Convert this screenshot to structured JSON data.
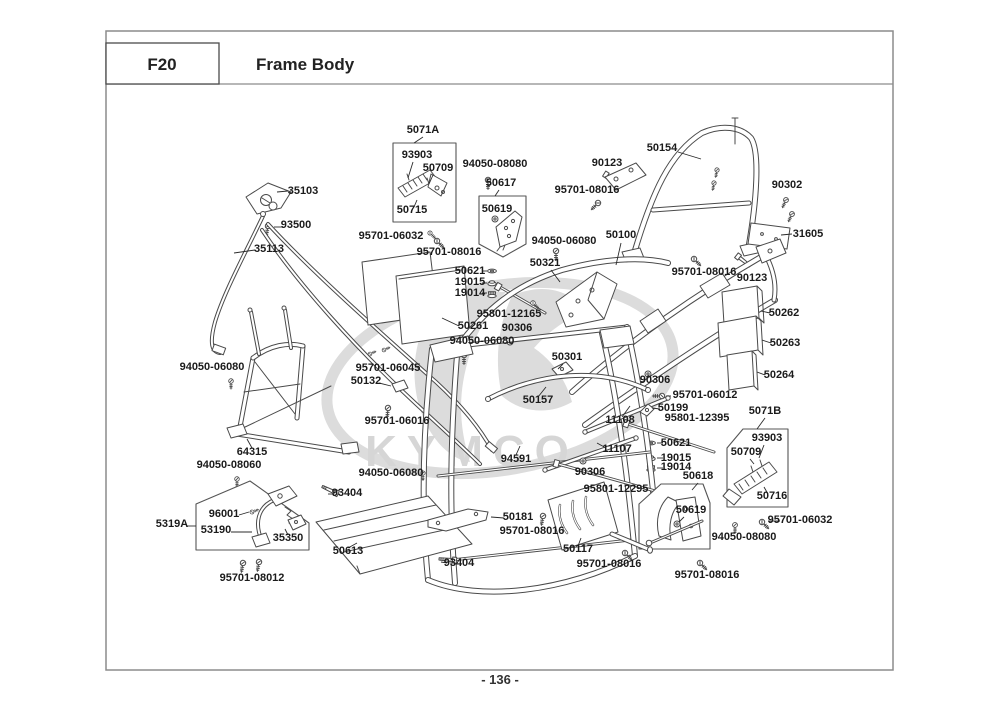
{
  "header": {
    "code": "F20",
    "title": "Frame Body"
  },
  "footer": {
    "page_number": "- 136 -"
  },
  "watermark": {
    "brand": "KYMCO"
  },
  "colors": {
    "ink": "#4a4a4a",
    "label": "#1b1b1b",
    "border": "#8c8c8c",
    "watermark": "#d6d6d6"
  },
  "diagram": {
    "labels": [
      {
        "text": "5071A",
        "x": 423,
        "y": 133,
        "leader": [
          423,
          137,
          414,
          143
        ]
      },
      {
        "text": "93903",
        "x": 417,
        "y": 158,
        "leader": [
          413,
          162,
          408,
          178
        ]
      },
      {
        "text": "50709",
        "x": 438,
        "y": 171,
        "leader": [
          433,
          175,
          429,
          184
        ]
      },
      {
        "text": "50715",
        "x": 412,
        "y": 213,
        "leader": [
          414,
          207,
          417,
          200
        ]
      },
      {
        "text": "94050-08080",
        "x": 495,
        "y": 167
      },
      {
        "text": "50617",
        "x": 501,
        "y": 186,
        "leader": [
          499,
          190,
          495,
          196
        ]
      },
      {
        "text": "50619",
        "x": 497,
        "y": 212
      },
      {
        "text": "90123",
        "x": 607,
        "y": 166
      },
      {
        "text": "50154",
        "x": 662,
        "y": 151,
        "leader": [
          678,
          152,
          701,
          159
        ]
      },
      {
        "text": "95701-08016",
        "x": 587,
        "y": 193
      },
      {
        "text": "90302",
        "x": 787,
        "y": 188
      },
      {
        "text": "95701-06032",
        "x": 391,
        "y": 239
      },
      {
        "text": "95701-08016",
        "x": 449,
        "y": 255
      },
      {
        "text": "94050-06080",
        "x": 564,
        "y": 244
      },
      {
        "text": "50100",
        "x": 621,
        "y": 238,
        "leader": [
          621,
          243,
          616,
          265
        ]
      },
      {
        "text": "31605",
        "x": 808,
        "y": 237,
        "leader": [
          792,
          234,
          781,
          235
        ]
      },
      {
        "text": "95701-08016",
        "x": 704,
        "y": 275
      },
      {
        "text": "90123",
        "x": 752,
        "y": 281
      },
      {
        "text": "50621",
        "x": 470,
        "y": 274,
        "leader": [
          482,
          271,
          487,
          271
        ]
      },
      {
        "text": "19015",
        "x": 470,
        "y": 285,
        "leader": [
          482,
          283,
          487,
          283
        ]
      },
      {
        "text": "19014",
        "x": 470,
        "y": 296,
        "leader": [
          482,
          293,
          487,
          293
        ]
      },
      {
        "text": "50321",
        "x": 545,
        "y": 266,
        "leader": [
          551,
          270,
          560,
          282
        ]
      },
      {
        "text": "95801-12165",
        "x": 509,
        "y": 317
      },
      {
        "text": "50261",
        "x": 473,
        "y": 329,
        "leader": [
          459,
          326,
          442,
          318
        ]
      },
      {
        "text": "90306",
        "x": 517,
        "y": 331
      },
      {
        "text": "50262",
        "x": 784,
        "y": 316,
        "leader": [
          770,
          313,
          761,
          311
        ]
      },
      {
        "text": "50263",
        "x": 785,
        "y": 346,
        "leader": [
          771,
          343,
          762,
          340
        ]
      },
      {
        "text": "94050-06080",
        "x": 482,
        "y": 344
      },
      {
        "text": "50301",
        "x": 567,
        "y": 360,
        "leader": [
          563,
          364,
          558,
          369
        ]
      },
      {
        "text": "50264",
        "x": 779,
        "y": 378,
        "leader": [
          765,
          375,
          757,
          372
        ]
      },
      {
        "text": "94050-06080",
        "x": 212,
        "y": 370
      },
      {
        "text": "95701-06045",
        "x": 388,
        "y": 371
      },
      {
        "text": "50132",
        "x": 366,
        "y": 384,
        "leader": [
          379,
          383,
          391,
          386
        ]
      },
      {
        "text": "90306",
        "x": 655,
        "y": 383
      },
      {
        "text": "95701-06012",
        "x": 705,
        "y": 398,
        "leader": [
          671,
          396,
          666,
          396
        ]
      },
      {
        "text": "50199",
        "x": 673,
        "y": 411,
        "leader": [
          660,
          409,
          652,
          408
        ]
      },
      {
        "text": "50157",
        "x": 538,
        "y": 403,
        "leader": [
          538,
          397,
          546,
          387
        ]
      },
      {
        "text": "95801-12395",
        "x": 697,
        "y": 421
      },
      {
        "text": "5071B",
        "x": 765,
        "y": 414,
        "leader": [
          765,
          418,
          757,
          429
        ]
      },
      {
        "text": "95701-06016",
        "x": 397,
        "y": 424
      },
      {
        "text": "11108",
        "x": 620,
        "y": 423,
        "leader": [
          622,
          417,
          630,
          406
        ]
      },
      {
        "text": "93903",
        "x": 767,
        "y": 441,
        "leader": [
          764,
          445,
          759,
          458
        ]
      },
      {
        "text": "50709",
        "x": 746,
        "y": 455,
        "leader": [
          750,
          459,
          754,
          464
        ]
      },
      {
        "text": "64315",
        "x": 252,
        "y": 455,
        "leader": [
          252,
          448,
          247,
          439
        ]
      },
      {
        "text": "11107",
        "x": 617,
        "y": 452,
        "leader": [
          606,
          448,
          597,
          443
        ]
      },
      {
        "text": "50621",
        "x": 676,
        "y": 446,
        "leader": [
          663,
          443,
          657,
          443
        ]
      },
      {
        "text": "19015",
        "x": 676,
        "y": 461,
        "leader": [
          663,
          458,
          657,
          458
        ]
      },
      {
        "text": "19014",
        "x": 676,
        "y": 470,
        "leader": [
          663,
          468,
          657,
          468
        ]
      },
      {
        "text": "94591",
        "x": 516,
        "y": 462,
        "leader": [
          516,
          455,
          520,
          446
        ]
      },
      {
        "text": "94050-08060",
        "x": 229,
        "y": 468
      },
      {
        "text": "90306",
        "x": 590,
        "y": 475
      },
      {
        "text": "50618",
        "x": 698,
        "y": 479,
        "leader": [
          698,
          483,
          692,
          490
        ]
      },
      {
        "text": "94050-06080",
        "x": 391,
        "y": 476
      },
      {
        "text": "50716",
        "x": 772,
        "y": 499,
        "leader": [
          768,
          494,
          764,
          487
        ]
      },
      {
        "text": "93404",
        "x": 347,
        "y": 496,
        "leader": [
          334,
          494,
          328,
          494
        ]
      },
      {
        "text": "96001",
        "x": 224,
        "y": 517,
        "leader": [
          239,
          515,
          249,
          512
        ]
      },
      {
        "text": "5319A",
        "x": 172,
        "y": 527,
        "leader": [
          187,
          526,
          196,
          526
        ]
      },
      {
        "text": "53190",
        "x": 216,
        "y": 533,
        "leader": [
          231,
          532,
          252,
          532
        ]
      },
      {
        "text": "50619",
        "x": 691,
        "y": 513,
        "leader": [
          684,
          517,
          679,
          522
        ]
      },
      {
        "text": "95701-06032",
        "x": 800,
        "y": 523,
        "leader": [
          780,
          521,
          768,
          521
        ]
      },
      {
        "text": "35350",
        "x": 288,
        "y": 541,
        "leader": [
          288,
          535,
          285,
          529
        ]
      },
      {
        "text": "50181",
        "x": 518,
        "y": 520,
        "leader": [
          504,
          518,
          491,
          517
        ]
      },
      {
        "text": "94050-08080",
        "x": 744,
        "y": 540
      },
      {
        "text": "95701-08016",
        "x": 532,
        "y": 534
      },
      {
        "text": "50613",
        "x": 348,
        "y": 554,
        "leader": [
          348,
          548,
          357,
          543
        ]
      },
      {
        "text": "93404",
        "x": 459,
        "y": 566,
        "leader": [
          447,
          563,
          441,
          562
        ]
      },
      {
        "text": "50117",
        "x": 578,
        "y": 552,
        "leader": [
          578,
          546,
          581,
          538
        ]
      },
      {
        "text": "95801-12295",
        "x": 616,
        "y": 492
      },
      {
        "text": "95701-08016",
        "x": 609,
        "y": 567
      },
      {
        "text": "95701-08016",
        "x": 707,
        "y": 578
      },
      {
        "text": "95701-08012",
        "x": 252,
        "y": 581
      },
      {
        "text": "35103",
        "x": 303,
        "y": 194,
        "leader": [
          288,
          191,
          277,
          192
        ]
      },
      {
        "text": "93500",
        "x": 296,
        "y": 228,
        "leader": [
          282,
          227,
          274,
          227
        ]
      },
      {
        "text": "35113",
        "x": 269,
        "y": 252,
        "leader": [
          255,
          250,
          234,
          253
        ]
      }
    ]
  }
}
